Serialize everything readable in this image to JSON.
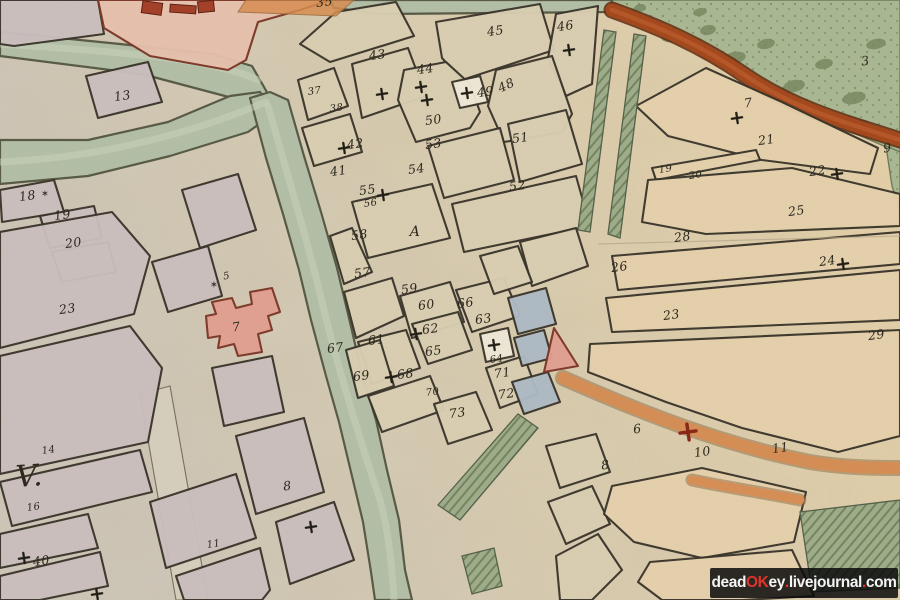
{
  "watermark": {
    "bg": "rgba(10,10,10,0.85)",
    "segments": [
      {
        "text": "dead",
        "color": "#f4f4f4"
      },
      {
        "text": "OK",
        "color": "#e0342b"
      },
      {
        "text": "ey",
        "color": "#f4f4f4"
      },
      {
        "text": ".",
        "color": "#e0342b"
      },
      {
        "text": "livejournal",
        "color": "#f4f4f4"
      },
      {
        "text": ".",
        "color": "#e0342b"
      },
      {
        "text": "com",
        "color": "#f4f4f4"
      }
    ]
  },
  "map": {
    "width": 900,
    "height": 600,
    "palette": {
      "paperA": "#d0c9bc",
      "paperB": "#dbcfb4",
      "paperC": "#e9d4ab",
      "lavender": "#cbc0bf",
      "beige": "#dbd0b4",
      "peach": "#e7d2ae",
      "white": "#f0ead9",
      "pink": "#e2a091",
      "pinkLight": "#e8c2ae",
      "blue": "#aebbc6",
      "ink": "#39342a",
      "label": "#2b271d",
      "river": "#b3bfa8",
      "riverEdge": "#575a45",
      "riverGlint": "#ced6bc",
      "green": "#aab894",
      "greenDark": "#74865c",
      "hatchBg": "#9fad8c",
      "rust": "#a5481c",
      "rustDark": "#5f2a0e",
      "rustHi": "#c06030",
      "orange": "#d98e52",
      "orangeEdge": "#8a6a42",
      "redCross": "#8a2616",
      "castleRed": "#a33f28",
      "roadPale": "#d7d0bf",
      "crease": "#b6a88b"
    },
    "riverPolys": [
      "0,32 120,44 212,54 252,66 268,94 240,100 142,74 0,56",
      "0,140 88,140 168,122 230,96 260,92 276,112 248,132 170,156 88,176 0,184",
      "250,98 266,158 283,214 299,270 311,320 326,376 339,422 351,472 363,522 371,572 375,600 412,600 405,570 399,520 387,470 376,420 362,374 349,318 337,268 321,212 304,156 288,100 270,92",
      "330,0 612,0 610,12 382,14 334,8"
    ],
    "riverCenters": [
      "M 0,44 C 120,52 210,58 258,80",
      "M 0,162 C 90,158 180,138 266,102",
      "M 268,106 C 286,170 306,235 322,302 C 338,368 360,440 380,500 C 388,528 392,565 394,600"
    ],
    "greens": [
      "604,0 900,0 900,152 884,146 842,128 788,104 726,70 664,34 616,12",
      "886,146 900,152 900,212 892,186"
    ],
    "blobs": [
      [
        644,
        22,
        9,
        5
      ],
      [
        672,
        36,
        11,
        6
      ],
      [
        708,
        30,
        8,
        5
      ],
      [
        734,
        58,
        12,
        6
      ],
      [
        766,
        44,
        9,
        5
      ],
      [
        794,
        86,
        11,
        6
      ],
      [
        824,
        64,
        9,
        5
      ],
      [
        854,
        98,
        12,
        6
      ],
      [
        876,
        44,
        10,
        5
      ],
      [
        700,
        12,
        7,
        4
      ],
      [
        860,
        124,
        8,
        4
      ],
      [
        640,
        8,
        6,
        4
      ]
    ],
    "rustRoad": "M 612,10 C 656,26 700,44 746,76 C 790,106 836,120 900,140",
    "orangeRoads": [
      {
        "d": "M 563,378 C 640,412 720,444 810,462 C 845,468 880,468 900,468",
        "w": 12
      },
      {
        "d": "M 692,480 C 730,488 760,492 800,500",
        "w": 9
      }
    ],
    "orangeStrip": "246,0 354,0 336,16 238,12",
    "westRoad": "140,394 170,386 208,600 176,600",
    "blocks": [
      {
        "f": "lavender",
        "p": "0,0 98,0 104,34 14,46 0,44"
      },
      {
        "f": "pinkLight",
        "p": "98,0 330,0 300,10 258,22 246,60 228,70 150,56 104,28"
      },
      {
        "f": "lavender",
        "p": "86,76 148,62 162,102 98,118"
      },
      {
        "f": "lavender",
        "p": "0,190 54,180 64,212 2,222"
      },
      {
        "f": "lavender",
        "p": "40,216 94,206 102,238 50,248"
      },
      {
        "f": "lavender",
        "p": "52,252 108,242 116,272 62,282"
      },
      {
        "f": "lavender",
        "p": "0,232 112,212 150,256 134,314 0,348"
      },
      {
        "f": "lavender",
        "p": "152,262 208,246 222,296 168,312"
      },
      {
        "f": "lavender",
        "p": "182,190 238,174 256,230 200,248"
      },
      {
        "f": "lavender",
        "p": "212,368 272,356 284,412 224,426"
      },
      {
        "f": "lavender",
        "p": "236,436 304,418 324,492 256,514"
      },
      {
        "f": "lavender",
        "p": "0,356 130,326 162,368 148,442 0,474"
      },
      {
        "f": "lavender",
        "p": "0,482 140,450 152,492 12,526"
      },
      {
        "f": "lavender",
        "p": "0,534 88,514 98,548 0,568"
      },
      {
        "f": "lavender",
        "p": "0,576 100,552 108,586 40,600 0,600"
      },
      {
        "f": "lavender",
        "p": "150,502 236,474 256,538 166,568"
      },
      {
        "f": "lavender",
        "p": "176,576 260,548 270,590 262,600 184,600"
      },
      {
        "f": "lavender",
        "p": "276,522 334,502 354,560 290,584"
      },
      {
        "f": "beige",
        "p": "300,44 336,12 396,2 414,36 330,62"
      },
      {
        "f": "beige",
        "p": "298,80 334,68 348,106 308,120"
      },
      {
        "f": "beige",
        "p": "302,128 350,114 362,152 314,166"
      },
      {
        "f": "beige",
        "p": "352,64 408,48 426,96 362,118"
      },
      {
        "f": "beige",
        "p": "436,22 540,4 554,50 462,80 442,58"
      },
      {
        "f": "beige",
        "p": "556,14 598,6 592,84 566,96 548,58"
      },
      {
        "f": "beige",
        "p": "404,70 446,62 470,84 480,112 470,128 416,142 398,100"
      },
      {
        "f": "beige",
        "p": "496,70 552,56 572,114 562,132 504,142 488,106"
      },
      {
        "f": "beige",
        "p": "428,146 500,128 514,180 444,198"
      },
      {
        "f": "beige",
        "p": "508,124 566,110 582,164 520,182"
      },
      {
        "f": "beige",
        "p": "452,204 576,176 590,226 464,252"
      },
      {
        "f": "beige",
        "p": "352,202 432,184 450,238 368,258"
      },
      {
        "f": "beige",
        "p": "330,236 352,228 372,272 344,284"
      },
      {
        "f": "beige",
        "p": "344,292 392,278 404,316 356,338"
      },
      {
        "f": "beige",
        "p": "400,296 450,282 464,322 412,338"
      },
      {
        "f": "beige",
        "p": "456,290 504,278 520,316 472,332"
      },
      {
        "f": "beige",
        "p": "358,342 406,330 420,368 372,384"
      },
      {
        "f": "beige",
        "p": "412,324 458,312 472,350 428,364"
      },
      {
        "f": "beige",
        "p": "346,350 380,340 394,386 358,398"
      },
      {
        "f": "beige",
        "p": "368,396 430,376 444,410 382,432"
      },
      {
        "f": "beige",
        "p": "486,368 524,356 538,394 500,408"
      },
      {
        "f": "beige",
        "p": "434,404 476,392 492,430 448,444"
      },
      {
        "f": "beige",
        "p": "520,242 576,228 588,266 532,286"
      },
      {
        "f": "beige",
        "p": "480,256 518,246 532,282 494,294"
      },
      {
        "f": "beige",
        "p": "546,446 596,434 610,472 560,488"
      },
      {
        "f": "beige",
        "p": "548,502 592,486 610,524 566,544"
      },
      {
        "f": "beige",
        "p": "556,556 598,534 622,570 592,600 560,600"
      },
      {
        "f": "peach",
        "p": "636,106 706,68 782,102 878,148 870,174 762,160 668,136"
      },
      {
        "f": "peach",
        "p": "652,168 756,150 760,160 656,180"
      },
      {
        "f": "peach",
        "p": "648,180 792,168 900,194 900,226 706,234 642,222"
      },
      {
        "f": "peach",
        "p": "612,256 900,232 900,264 618,290"
      },
      {
        "f": "peach",
        "p": "606,298 900,270 900,320 612,332"
      },
      {
        "f": "peach",
        "p": "590,344 900,330 900,436 838,452 742,428 666,402 588,372"
      },
      {
        "f": "peach",
        "p": "612,486 702,468 806,492 794,542 702,558 634,542 604,514"
      },
      {
        "f": "peach",
        "p": "650,562 792,550 814,596 742,600 662,600 638,582"
      },
      {
        "f": "white",
        "p": "452,82 480,76 488,102 460,108"
      },
      {
        "f": "white",
        "p": "480,334 508,328 514,356 486,362"
      },
      {
        "f": "blue",
        "p": "508,298 546,288 556,324 518,334"
      },
      {
        "f": "blue",
        "p": "514,338 544,330 552,358 522,366"
      },
      {
        "f": "blue",
        "p": "512,382 548,372 560,402 524,414"
      },
      {
        "f": "pink",
        "p": "212,302 232,298 236,308 252,304 250,292 272,288 280,312 268,316 272,330 258,334 262,352 238,356 234,344 218,348 220,336 208,338 206,316 216,314"
      },
      {
        "f": "pink",
        "p": "554,328 578,366 544,372"
      }
    ],
    "hatches": [
      "438,505 518,414 538,428 460,520",
      "462,556 494,548 502,586 472,594",
      "800,512 900,500 900,588 812,592",
      "604,30 616,32 590,232 578,230",
      "634,34 646,36 620,238 608,234"
    ],
    "castleMarks": [
      [
        142,
        2,
        20,
        12,
        8
      ],
      [
        170,
        5,
        26,
        8,
        4
      ],
      [
        198,
        1,
        16,
        11,
        -6
      ]
    ],
    "creases": [
      [
        598,
        244,
        900,
        236
      ]
    ],
    "labels": [
      {
        "t": "13",
        "x": 123,
        "y": 100
      },
      {
        "t": "18",
        "x": 28,
        "y": 200
      },
      {
        "t": "19",
        "x": 63,
        "y": 219
      },
      {
        "t": "20",
        "x": 74,
        "y": 247
      },
      {
        "t": "23",
        "x": 68,
        "y": 313
      },
      {
        "t": "5",
        "x": 227,
        "y": 279,
        "s": 10
      },
      {
        "t": "7",
        "x": 237,
        "y": 331
      },
      {
        "t": "V.",
        "x": 30,
        "y": 486,
        "s": 30,
        "r": -4
      },
      {
        "t": "14",
        "x": 49,
        "y": 453,
        "s": 10
      },
      {
        "t": "16",
        "x": 34,
        "y": 510,
        "s": 10
      },
      {
        "t": "40",
        "x": 42,
        "y": 565
      },
      {
        "t": "8",
        "x": 288,
        "y": 490
      },
      {
        "t": "11",
        "x": 214,
        "y": 547,
        "s": 10
      },
      {
        "t": "35",
        "x": 325,
        "y": 6
      },
      {
        "t": "43",
        "x": 378,
        "y": 59
      },
      {
        "t": "45",
        "x": 496,
        "y": 35
      },
      {
        "t": "46",
        "x": 566,
        "y": 30
      },
      {
        "t": "44",
        "x": 426,
        "y": 73
      },
      {
        "t": "49",
        "x": 486,
        "y": 96
      },
      {
        "t": "48",
        "x": 508,
        "y": 89,
        "r": -25
      },
      {
        "t": "50",
        "x": 434,
        "y": 124
      },
      {
        "t": "53",
        "x": 434,
        "y": 148
      },
      {
        "t": "54",
        "x": 417,
        "y": 173
      },
      {
        "t": "51",
        "x": 521,
        "y": 142
      },
      {
        "t": "52",
        "x": 518,
        "y": 190
      },
      {
        "t": "42",
        "x": 356,
        "y": 148
      },
      {
        "t": "41",
        "x": 339,
        "y": 175
      },
      {
        "t": "37",
        "x": 315,
        "y": 94,
        "s": 10
      },
      {
        "t": "38",
        "x": 337,
        "y": 111,
        "s": 10
      },
      {
        "t": "55",
        "x": 368,
        "y": 194
      },
      {
        "t": "56",
        "x": 371,
        "y": 206,
        "s": 10
      },
      {
        "t": "A",
        "x": 415,
        "y": 236,
        "s": 14,
        "r": 0
      },
      {
        "t": "58",
        "x": 360,
        "y": 239
      },
      {
        "t": "57",
        "x": 363,
        "y": 277
      },
      {
        "t": "59",
        "x": 410,
        "y": 293
      },
      {
        "t": "60",
        "x": 427,
        "y": 309
      },
      {
        "t": "66",
        "x": 466,
        "y": 307
      },
      {
        "t": "63",
        "x": 484,
        "y": 323
      },
      {
        "t": "62",
        "x": 431,
        "y": 333
      },
      {
        "t": "61",
        "x": 377,
        "y": 344
      },
      {
        "t": "65",
        "x": 434,
        "y": 355
      },
      {
        "t": "64",
        "x": 497,
        "y": 362,
        "s": 10
      },
      {
        "t": "67",
        "x": 336,
        "y": 352
      },
      {
        "t": "69",
        "x": 362,
        "y": 380
      },
      {
        "t": "68",
        "x": 406,
        "y": 378
      },
      {
        "t": "70",
        "x": 433,
        "y": 395,
        "s": 10
      },
      {
        "t": "71",
        "x": 503,
        "y": 377
      },
      {
        "t": "72",
        "x": 507,
        "y": 398
      },
      {
        "t": "73",
        "x": 458,
        "y": 417
      },
      {
        "t": "26",
        "x": 620,
        "y": 271
      },
      {
        "t": "28",
        "x": 683,
        "y": 241
      },
      {
        "t": "23",
        "x": 672,
        "y": 319
      },
      {
        "t": "25",
        "x": 797,
        "y": 215
      },
      {
        "t": "29",
        "x": 877,
        "y": 339
      },
      {
        "t": "22",
        "x": 818,
        "y": 175
      },
      {
        "t": "24",
        "x": 828,
        "y": 265
      },
      {
        "t": "21",
        "x": 767,
        "y": 144
      },
      {
        "t": "9",
        "x": 888,
        "y": 152
      },
      {
        "t": "3",
        "x": 866,
        "y": 65
      },
      {
        "t": "7",
        "x": 749,
        "y": 107
      },
      {
        "t": "19",
        "x": 666,
        "y": 172,
        "s": 10
      },
      {
        "t": "20",
        "x": 696,
        "y": 178,
        "s": 10
      },
      {
        "t": "10",
        "x": 703,
        "y": 456
      },
      {
        "t": "11",
        "x": 781,
        "y": 452
      },
      {
        "t": "6",
        "x": 638,
        "y": 433
      },
      {
        "t": "8",
        "x": 606,
        "y": 469
      }
    ],
    "crosses": [
      {
        "x": 421,
        "y": 87
      },
      {
        "x": 427,
        "y": 100
      },
      {
        "x": 382,
        "y": 94
      },
      {
        "x": 467,
        "y": 93
      },
      {
        "x": 569,
        "y": 50
      },
      {
        "x": 344,
        "y": 148
      },
      {
        "x": 383,
        "y": 195
      },
      {
        "x": 416,
        "y": 334
      },
      {
        "x": 494,
        "y": 345
      },
      {
        "x": 391,
        "y": 377
      },
      {
        "x": 24,
        "y": 558
      },
      {
        "x": 737,
        "y": 118
      },
      {
        "x": 837,
        "y": 174
      },
      {
        "x": 843,
        "y": 264
      },
      {
        "x": 311,
        "y": 527
      },
      {
        "x": 97,
        "y": 594
      },
      {
        "x": 688,
        "y": 432,
        "s": 8,
        "c": "red"
      }
    ],
    "stars": [
      [
        45,
        197
      ],
      [
        214,
        288
      ]
    ]
  }
}
